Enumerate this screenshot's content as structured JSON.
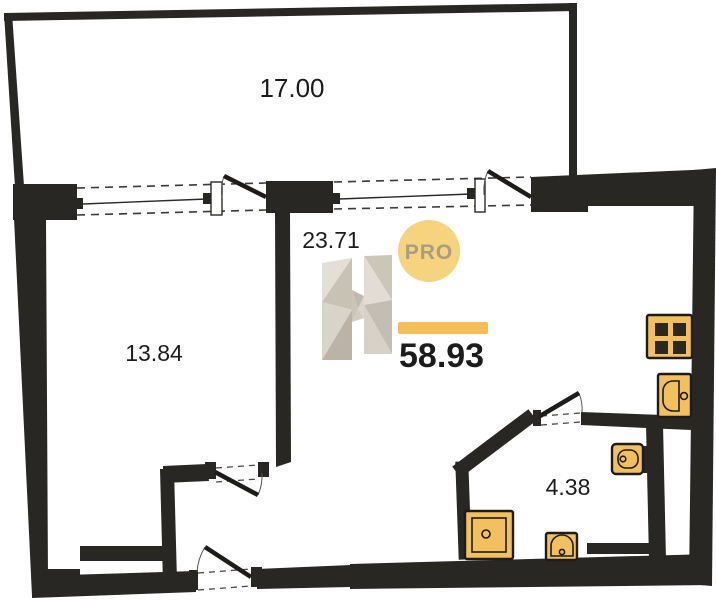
{
  "plan_type": "apartment-floor-plan",
  "summary": {
    "total_area": "58.93"
  },
  "rooms": [
    {
      "id": "balcony",
      "area": "17.00"
    },
    {
      "id": "living-room",
      "area": "23.71"
    },
    {
      "id": "left-room",
      "area": "13.84"
    },
    {
      "id": "bathroom",
      "area": "4.38"
    }
  ],
  "brand": {
    "badge_label": "PRO",
    "watermark_letter": "H"
  },
  "fixtures": [
    {
      "name": "stove"
    },
    {
      "name": "kitchen-sink"
    },
    {
      "name": "toilet"
    },
    {
      "name": "washbasin"
    },
    {
      "name": "shower"
    }
  ],
  "colors": {
    "wall": "#282724",
    "fixture_fill": "#f2c05e",
    "accent_bar": "#f3be58",
    "badge_fill": "#f6d37d",
    "badge_text": "#a89c85",
    "watermark_grays": [
      "#e2ddd4",
      "#c6bfb2",
      "#d8d2c7",
      "#b7afa2",
      "#cac3b6",
      "#e0dbd2"
    ]
  }
}
